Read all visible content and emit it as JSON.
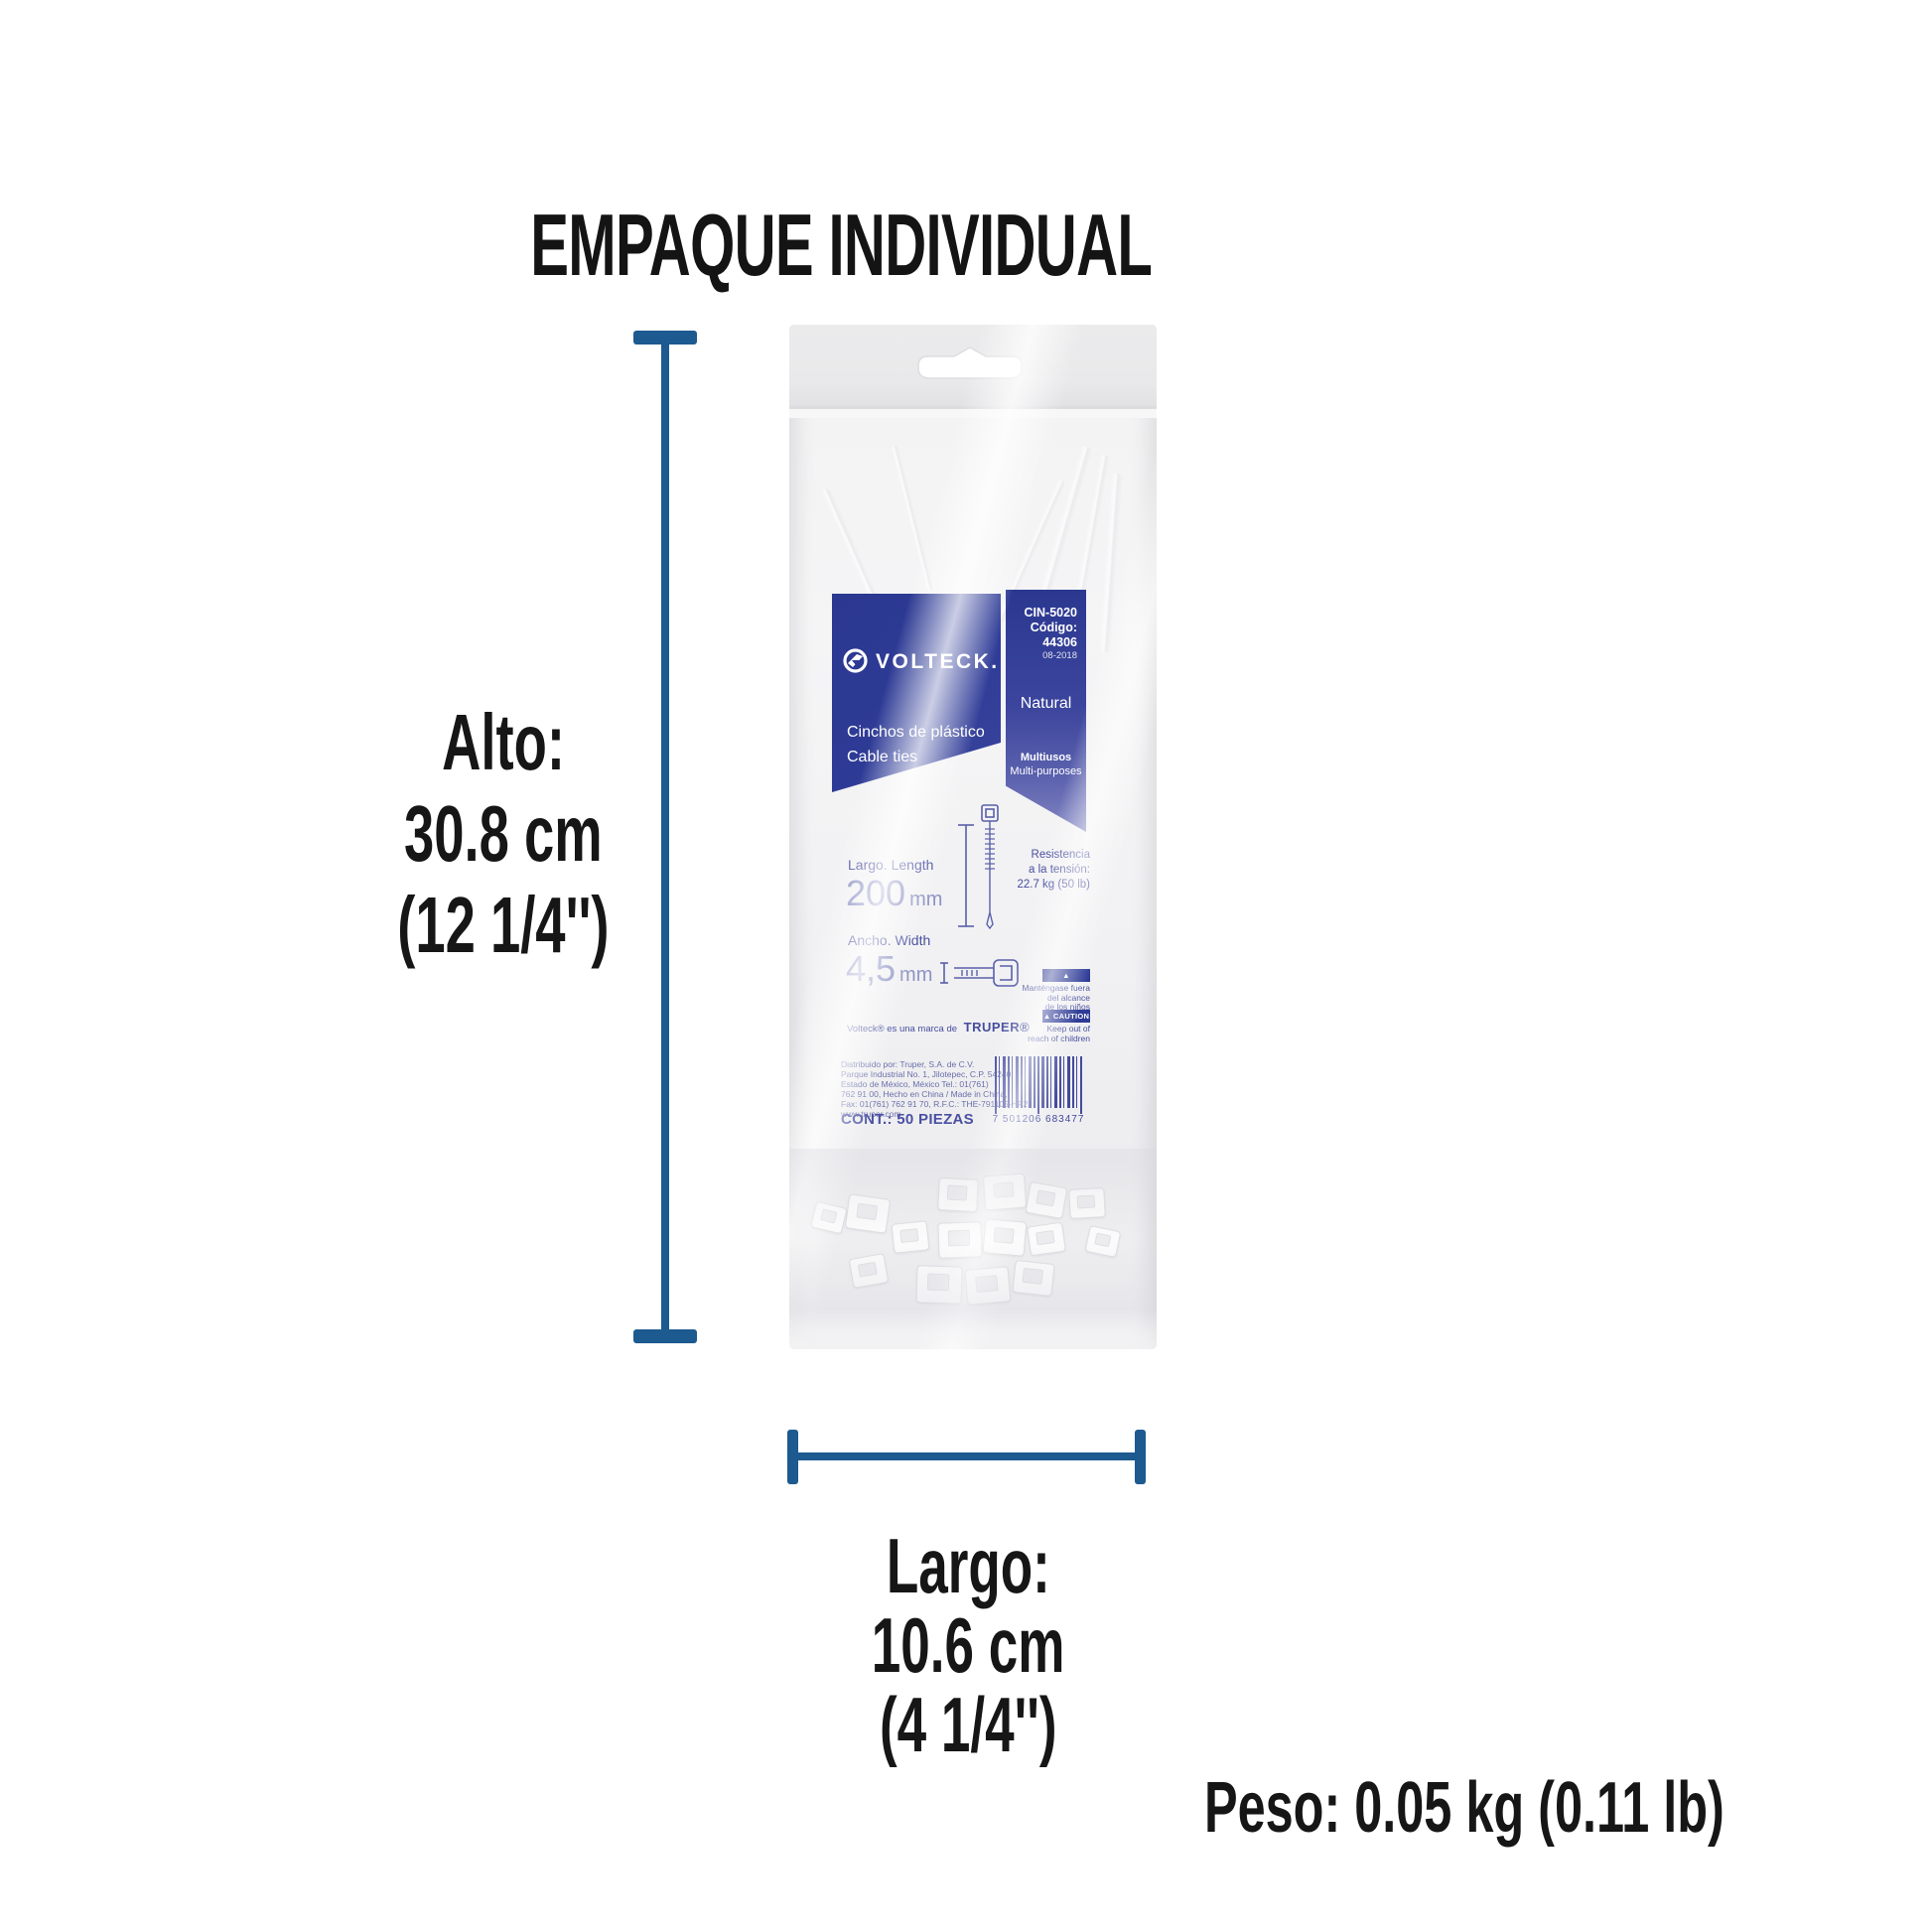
{
  "page": {
    "title": "EMPAQUE INDIVIDUAL",
    "weight_label": "Peso: 0.05 kg (0.11 lb)"
  },
  "dimensions": {
    "height": {
      "label": "Alto:",
      "value": "30.8 cm",
      "imperial": "(12 1/4'')"
    },
    "width": {
      "label": "Largo:",
      "value": "10.6 cm",
      "imperial": "(4 1/4'')"
    }
  },
  "package_label": {
    "brand": "VOLTECK.",
    "sku": "CIN-5020",
    "code": "Código: 44306",
    "date": "08-2018",
    "product_es": "Cinchos de plástico",
    "product_en": "Cable ties",
    "color_name": "Natural",
    "use_es": "Multiusos",
    "use_en": "Multi-purposes",
    "length_label": "Largo. Length",
    "length_value": "200",
    "length_unit": "mm",
    "width_label": "Ancho. Width",
    "width_value": "4,5",
    "width_unit": "mm",
    "tension_lines": [
      "Resistencia",
      "a la tensión:",
      "22.7 kg (50 lb)"
    ],
    "attention_badge": "▲ ATENCIÓN",
    "attention_lines": [
      "Manténgase fuera",
      "del alcance",
      "de los niños"
    ],
    "caution_badge": "▲ CAUTION",
    "caution_lines": [
      "Keep out of",
      "reach of children"
    ],
    "trademark_text": "Volteck® es una marca de",
    "trademark_brand": "TRUPER®",
    "address_lines": [
      "Distribuido por: Truper, S.A. de C.V.",
      "Parque Industrial No. 1, Jilotepec, C.P. 54240,",
      "Estado de México, México Tel.: 01(761)",
      "762 91 00, Hecho en China / Made in China,",
      "Fax: 01(761) 762 91 70, R.F.C.: THE-791105-HP2",
      "www.truper.com"
    ],
    "content_text": "CONT.: 50 PIEZAS",
    "barcode_digits": "7 501206 683477"
  },
  "colors": {
    "label_blue": "#2e3b96",
    "measure_blue": "#1c5a90",
    "print_navy": "#474d9e",
    "text_black": "#141414"
  }
}
